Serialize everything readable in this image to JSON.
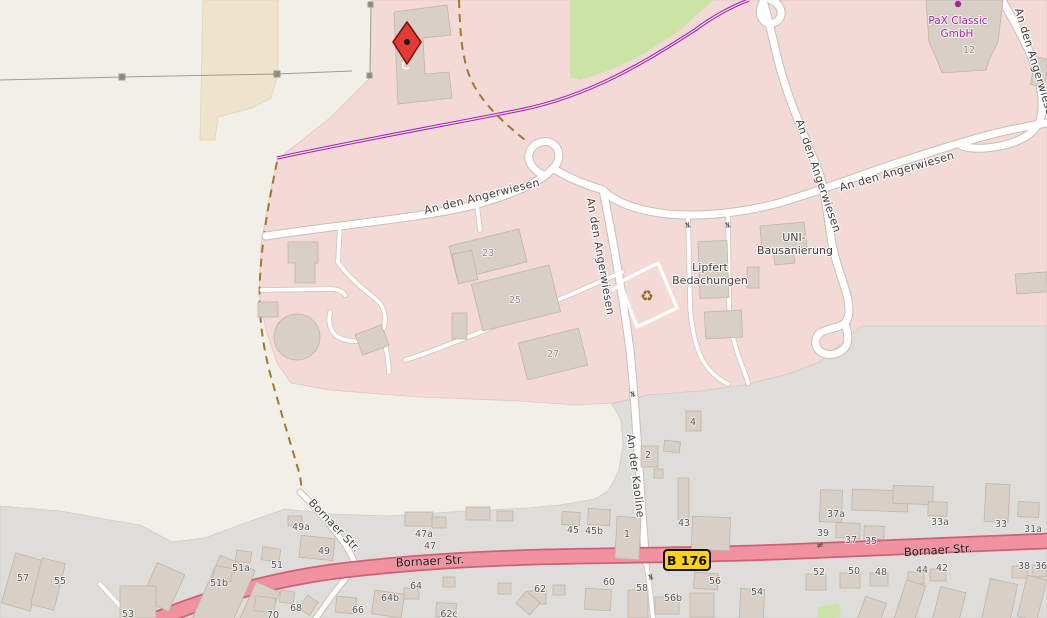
{
  "map": {
    "streets": {
      "an_den_angerwiesen": "An den Angerwiesen",
      "an_der_kaoline": "An der Kaoline",
      "bornaer_str": "Bornaer Str."
    },
    "road_badge": "B 176",
    "businesses": {
      "pax": [
        "PaX Classic",
        "GmbH"
      ],
      "lipfert": [
        "Lipfert",
        "Bedachungen"
      ],
      "uni": [
        "UNI-",
        "Bausanierung"
      ]
    },
    "glyphs": {
      "recycling": "♻",
      "gate": "≠"
    },
    "house_numbers": [
      {
        "t": "57",
        "x": 23,
        "y": 581
      },
      {
        "t": "55",
        "x": 60,
        "y": 584
      },
      {
        "t": "53",
        "x": 128,
        "y": 617
      },
      {
        "t": "51b",
        "x": 219,
        "y": 586
      },
      {
        "t": "51a",
        "x": 241,
        "y": 571
      },
      {
        "t": "51",
        "x": 277,
        "y": 568
      },
      {
        "t": "70",
        "x": 273,
        "y": 618
      },
      {
        "t": "68",
        "x": 296,
        "y": 611
      },
      {
        "t": "66",
        "x": 358,
        "y": 613
      },
      {
        "t": "64b",
        "x": 390,
        "y": 601
      },
      {
        "t": "64",
        "x": 416,
        "y": 589
      },
      {
        "t": "62c",
        "x": 449,
        "y": 617
      },
      {
        "t": "62",
        "x": 540,
        "y": 592
      },
      {
        "t": "60",
        "x": 609,
        "y": 585
      },
      {
        "t": "58",
        "x": 642,
        "y": 591
      },
      {
        "t": "56b",
        "x": 673,
        "y": 601
      },
      {
        "t": "56",
        "x": 715,
        "y": 584
      },
      {
        "t": "54",
        "x": 757,
        "y": 595
      },
      {
        "t": "49a",
        "x": 301,
        "y": 530
      },
      {
        "t": "49",
        "x": 324,
        "y": 554
      },
      {
        "t": "47a",
        "x": 424,
        "y": 537
      },
      {
        "t": "47",
        "x": 430,
        "y": 549
      },
      {
        "t": "45",
        "x": 573,
        "y": 533
      },
      {
        "t": "45b",
        "x": 594,
        "y": 534
      },
      {
        "t": "1",
        "x": 627,
        "y": 537
      },
      {
        "t": "43",
        "x": 684,
        "y": 526
      },
      {
        "t": "2",
        "x": 648,
        "y": 458
      },
      {
        "t": "4",
        "x": 693,
        "y": 425
      },
      {
        "t": "37a",
        "x": 836,
        "y": 517
      },
      {
        "t": "39",
        "x": 823,
        "y": 536
      },
      {
        "t": "37",
        "x": 851,
        "y": 543
      },
      {
        "t": "35",
        "x": 871,
        "y": 544
      },
      {
        "t": "33a",
        "x": 940,
        "y": 525
      },
      {
        "t": "33",
        "x": 1001,
        "y": 527
      },
      {
        "t": "31a",
        "x": 1033,
        "y": 532
      },
      {
        "t": "52",
        "x": 819,
        "y": 575
      },
      {
        "t": "50",
        "x": 854,
        "y": 574
      },
      {
        "t": "48",
        "x": 881,
        "y": 575
      },
      {
        "t": "44",
        "x": 922,
        "y": 573
      },
      {
        "t": "42",
        "x": 942,
        "y": 571
      },
      {
        "t": "38",
        "x": 1024,
        "y": 569
      },
      {
        "t": "36",
        "x": 1041,
        "y": 569
      },
      {
        "t": "23",
        "x": 488,
        "y": 256,
        "light": true
      },
      {
        "t": "25",
        "x": 515,
        "y": 303,
        "light": true
      },
      {
        "t": "27",
        "x": 553,
        "y": 357,
        "light": true
      },
      {
        "t": "12",
        "x": 969,
        "y": 53,
        "light": true
      }
    ],
    "colors": {
      "background": "#f2efe9",
      "industrial_area": "#f3dad7",
      "residential_area": "#dfddda",
      "farmland_patch": "#efe3cc",
      "scrub_green": "#cbe3a5",
      "primary_road": "#f0929f",
      "primary_road_casing": "#cf5f78",
      "road_badge_bg": "#fcd116",
      "business_label": "#a822a0",
      "pipeline_purple": "#a21dbb",
      "track_dashed": "#a5772a",
      "marker_red": "#e23b34"
    }
  }
}
